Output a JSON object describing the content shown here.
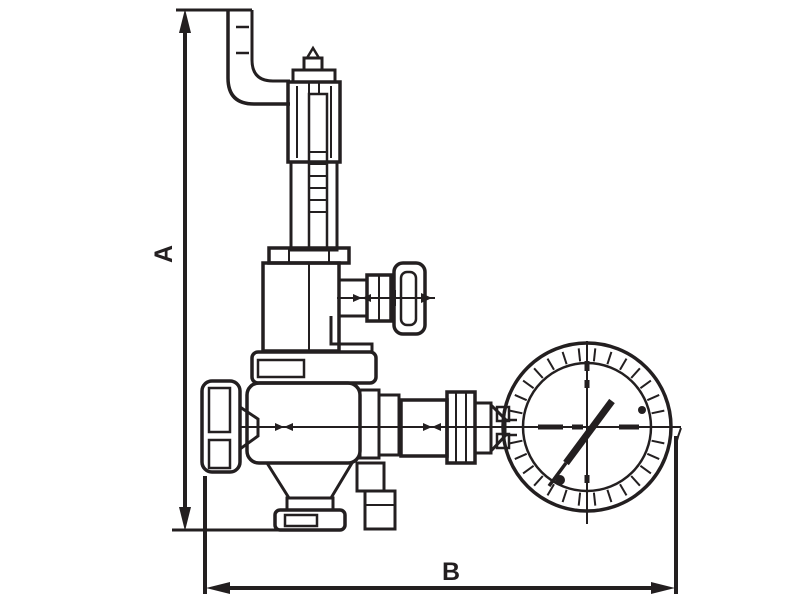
{
  "figure": {
    "kind": "technical line drawing",
    "subject": "pressure reducing valve with elbow pipe, side handwheel and pressure gauge",
    "labels": {
      "dim_vertical": "A",
      "dim_horizontal": "B"
    },
    "colors": {
      "line": "#231f20",
      "background": "#ffffff"
    }
  }
}
